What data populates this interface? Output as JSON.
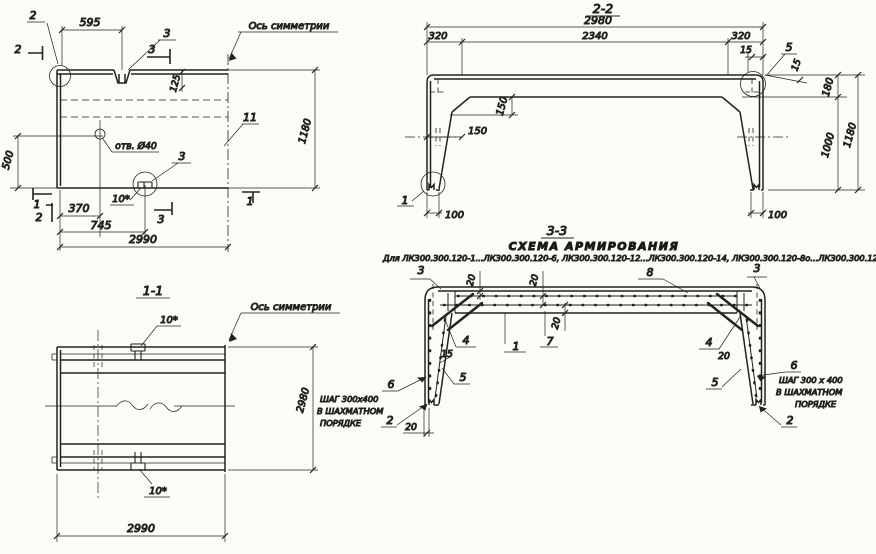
{
  "plan": {
    "axis_label": "Ось симметрии",
    "dim_595": "595",
    "dim_125": "125",
    "dim_1180": "1180",
    "dim_500": "500",
    "dim_370": "370",
    "dim_745": "745",
    "dim_2990": "2990",
    "hole_label": "отв. Ø40",
    "pos_11": "11",
    "label_3_top": "3",
    "label_3_bottom": "3",
    "mark_10": "10*",
    "detail_2": "2",
    "cut_2_left": "2",
    "cut_2_bottom": "2",
    "cut_3_top": "3",
    "cut_3_bottom": "3",
    "cut_1_left": "1",
    "cut_1_right": "1"
  },
  "section22": {
    "title": "2-2",
    "dim_2980": "2980",
    "dim_320_left": "320",
    "dim_2340": "2340",
    "dim_320_right": "320",
    "dim_15_top": "15",
    "dim_15_slope": "15",
    "label_5": "5",
    "dim_180": "180",
    "dim_150_v": "150",
    "dim_150_h": "150",
    "dim_1000": "1000",
    "dim_1180": "1180",
    "dim_100_left": "100",
    "dim_100_right": "100",
    "label_1": "1"
  },
  "section33": {
    "title": "3-3",
    "subtitle": "СХЕМА АРМИРОВАНИЯ",
    "applicability": "Для ЛК300.300.120-1...ЛК300.300.120-6, ЛК300.300.120-12...ЛК300.300.120-14, ЛК300.300.120-8о...ЛК300.300.120-11о",
    "label_3_left": "3",
    "label_3_right": "3",
    "label_8": "8",
    "label_4_left": "4",
    "label_4_right": "4",
    "label_1": "1",
    "label_7": "7",
    "label_5_left": "5",
    "label_5_right": "5",
    "label_6_left": "6",
    "label_6_right": "6",
    "label_2_left": "2",
    "label_2_right": "2",
    "dim_20_top1": "20",
    "dim_20_top2": "20",
    "dim_20_mid": "20",
    "dim_20_bottom": "20",
    "dim_20_right": "20",
    "dim_15": "15",
    "note_left": {
      "line1": "ШАГ 300х400",
      "line2": "В ШАХМАТНОМ",
      "line3": "ПОРЯДКЕ"
    },
    "note_right": {
      "line1": "ШАГ 300 х 400",
      "line2": "В ШАХМАТНОМ",
      "line3": "ПОРЯДКЕ"
    }
  },
  "section11": {
    "title": "1-1",
    "axis_label": "Ось симметрии",
    "mark_10_top": "10*",
    "mark_10_bottom": "10*",
    "dim_2980": "2980",
    "dim_2990": "2990"
  }
}
